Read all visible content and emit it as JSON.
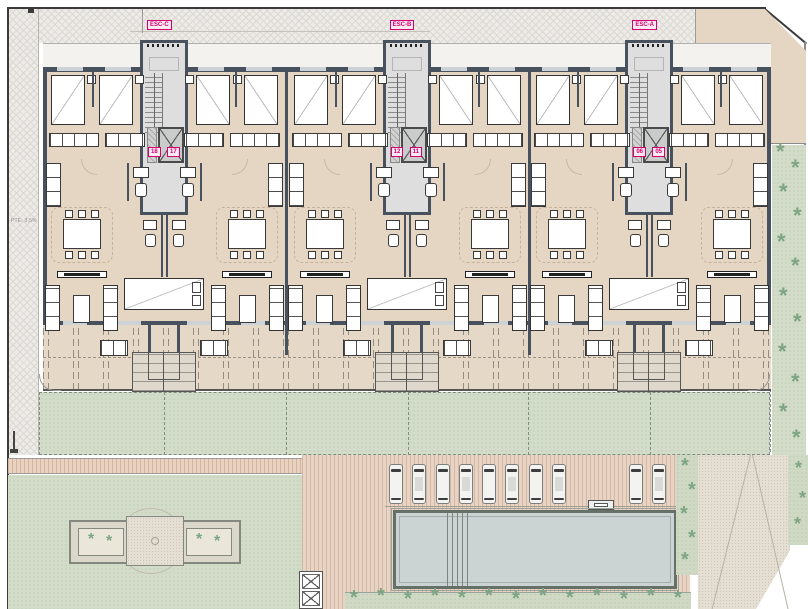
{
  "drawing": {
    "type": "architectural-site-floor-plan",
    "annotations": {
      "slope_note": "PTE: 3,5%"
    }
  },
  "building": {
    "stairs": [
      {
        "esc": "ESC-C",
        "units": [
          "18",
          "17"
        ]
      },
      {
        "esc": "ESC-B",
        "units": [
          "12",
          "11"
        ]
      },
      {
        "esc": "ESC-A",
        "units": [
          "06",
          "05"
        ]
      }
    ],
    "module_count": 3,
    "apartment_count": 6
  },
  "site": {
    "parking": {
      "car_count": 10,
      "cars_x": [
        389,
        412,
        436,
        459,
        482,
        505,
        529,
        552,
        629,
        652
      ],
      "cars_y": 464
    },
    "pool": {
      "x": 393,
      "y": 510,
      "width": 284,
      "height": 79
    },
    "palms": {
      "right_strip": [
        [
          776,
          152
        ],
        [
          791,
          168
        ],
        [
          779,
          192
        ],
        [
          793,
          216
        ],
        [
          777,
          242
        ],
        [
          791,
          266
        ],
        [
          779,
          296
        ],
        [
          793,
          322
        ],
        [
          778,
          352
        ],
        [
          791,
          382
        ],
        [
          779,
          412
        ],
        [
          792,
          438
        ]
      ],
      "column": [
        [
          681,
          466
        ],
        [
          688,
          490
        ],
        [
          680,
          514
        ],
        [
          688,
          538
        ],
        [
          681,
          560
        ]
      ],
      "bottom_bed": [
        [
          350,
          598
        ],
        [
          377,
          596
        ],
        [
          404,
          599
        ],
        [
          431,
          596
        ],
        [
          458,
          598
        ],
        [
          485,
          596
        ],
        [
          512,
          599
        ],
        [
          539,
          596
        ],
        [
          566,
          598
        ],
        [
          593,
          596
        ],
        [
          620,
          599
        ],
        [
          647,
          596
        ],
        [
          674,
          598
        ]
      ],
      "planter": [
        [
          88,
          540
        ],
        [
          106,
          542
        ],
        [
          196,
          540
        ],
        [
          214,
          542
        ]
      ],
      "right_lower": [
        [
          795,
          468
        ],
        [
          799,
          498
        ],
        [
          794,
          524
        ]
      ]
    }
  },
  "colors": {
    "accent_pink": "#d4006e",
    "wall": "#47525e",
    "floor_beige": "#e5d6c3",
    "lawn_green": "#d3dcc8",
    "pool_water": "#ccd4d3",
    "paving_pink": "#e9d3c3"
  }
}
